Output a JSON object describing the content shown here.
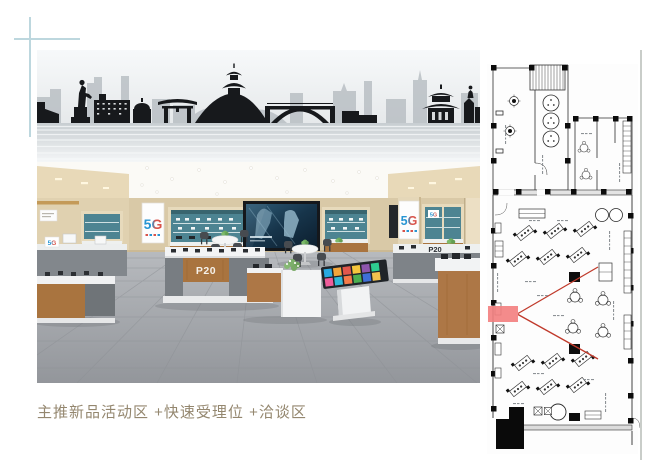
{
  "page": {
    "background": "#ffffff",
    "caption": {
      "text": "主推新品活动区 +快速受理位 +洽谈区",
      "color": "#94876F"
    }
  },
  "store_render": {
    "signage": {
      "fiveg": "5G",
      "p20": "P20"
    },
    "colors": {
      "mural_silhouette": "#17191c",
      "mural_background_buildings": "#b5bbc1",
      "wall_beige": "#d9c9a7",
      "cabinet_teal": "#4d8492",
      "counter_wood": "#a9743f",
      "counter_gray": "#787d82",
      "floor_gray": "#a4a8ad"
    }
  },
  "floor_plan": {
    "line_color": "#2f2f2f",
    "highlight_fill": "#f37e7e",
    "sight_line_color": "#c03a2b"
  },
  "decorations": {
    "crosshair_color": "#bdd7de",
    "side_rule_color": "#c9cdc9"
  }
}
